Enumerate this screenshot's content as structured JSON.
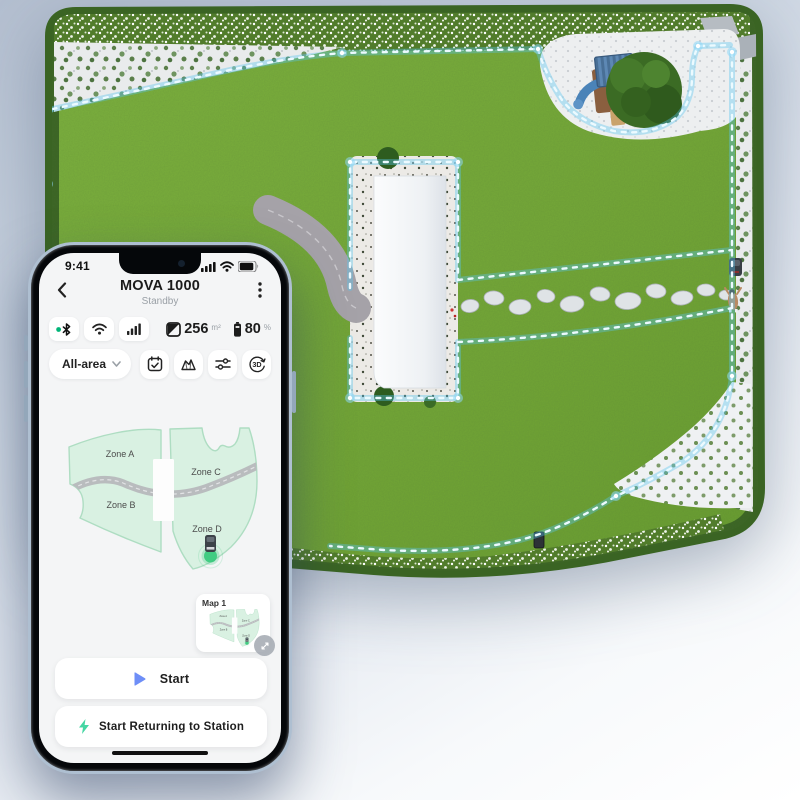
{
  "status_bar": {
    "time": "9:41"
  },
  "header": {
    "title": "MOVA 1000",
    "status": "Standby"
  },
  "connectivity": {
    "items": [
      "bluetooth",
      "wifi",
      "signal-strength"
    ]
  },
  "stats": {
    "area_value": "256",
    "area_unit": "m²",
    "battery_value": "80",
    "battery_unit": "%"
  },
  "toolbar": {
    "area_selector": "All-area",
    "icons": [
      "schedule-calendar",
      "map-terrain",
      "settings-sliders",
      "3d-view"
    ],
    "icon_3d_label": "3D"
  },
  "zones": {
    "a": {
      "label": "Zone A"
    },
    "b": {
      "label": "Zone B"
    },
    "c": {
      "label": "Zone C"
    },
    "d": {
      "label": "Zone D"
    }
  },
  "map_card": {
    "label": "Map 1"
  },
  "actions": {
    "start": "Start",
    "return_to_station": "Start Returning to Station"
  },
  "scene": {
    "description": "3D rendered lawn with LED virtual boundary, house, playground, robot mower, charging dock"
  },
  "colors": {
    "accent_blue": "#6e8ef7",
    "success_green": "#45d6a3",
    "bluetooth_green": "#00b578",
    "zone_mint": "#d9f1e2",
    "zone_border": "#aeddc2",
    "led_blue": "#bfe9ff",
    "grass_green": "#74a837",
    "hedge_green": "#3a6423"
  }
}
